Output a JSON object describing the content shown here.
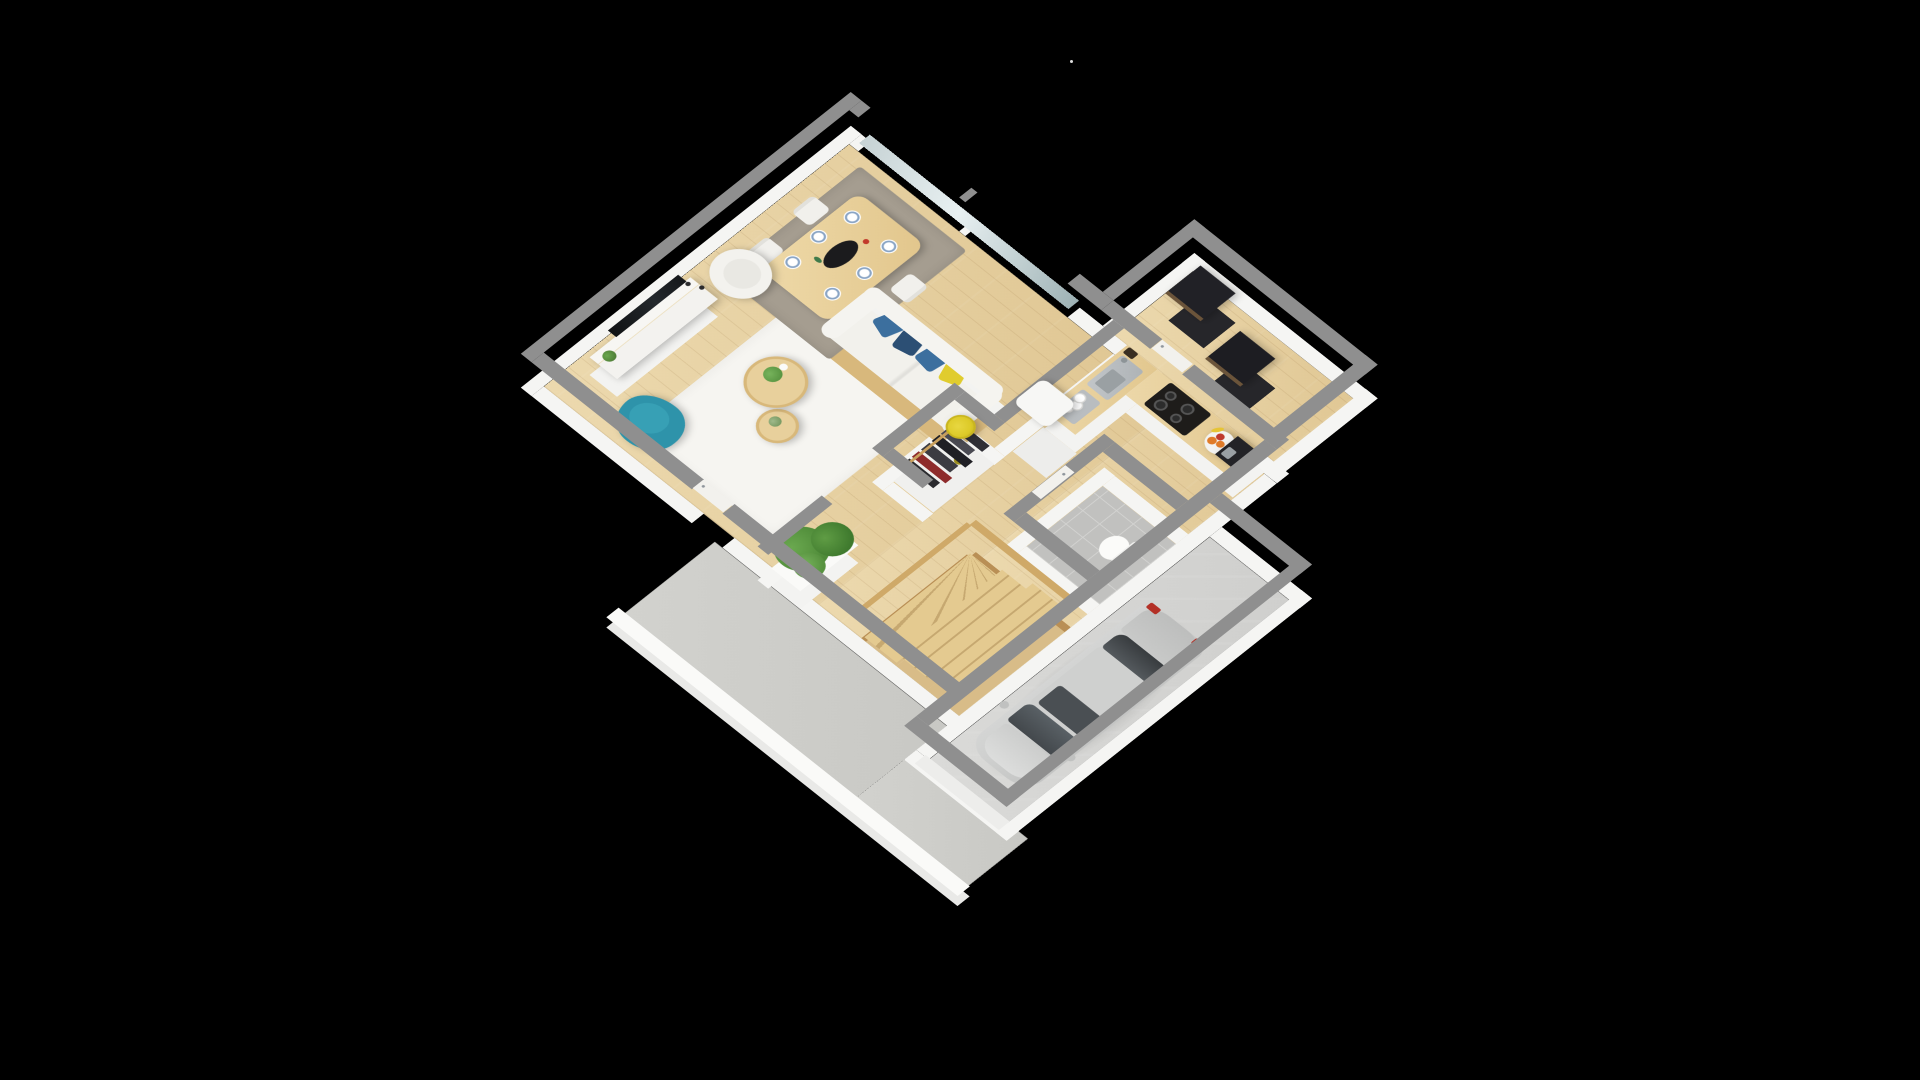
{
  "scene": {
    "label": "3D isometric floor plan of a single-storey house on black background",
    "background_color": "#000000",
    "view": "isometric top-down, plan rotated ~45 degrees",
    "artifact_dot": {
      "x": 1070,
      "y": 60,
      "color": "#dcdcdc"
    }
  },
  "palette": {
    "wall_top": "#8f8f8f",
    "wall_face": "#f5f5f3",
    "wood_floor": "#e7d2a3",
    "garage_floor": "#d5d5d3",
    "tile_floor": "#c1c1bf",
    "concrete": "#cdcdc9",
    "rug_white": "#f6f5f1",
    "rug_taupe": "#a59d90",
    "teal_chair": "#2e93aa",
    "yellow_accent": "#ddca28",
    "sofa_white": "#f2f1ec",
    "pillow_blue": "#3c6f9e",
    "pillow_dark_blue": "#2c4f74",
    "pillow_yellow": "#e0cc2e",
    "plant_green": "#4e8a38",
    "counter_wood": "#e9d3a4",
    "hob_black": "#1e1c1a",
    "car_silver": "#cbcccb",
    "cabinet_black": "#212126",
    "garment_red": "#8e2b2b"
  },
  "rooms": [
    {
      "label": "Living / dining room",
      "floor": "light oak wood"
    },
    {
      "label": "Dining area",
      "floor": "light oak wood"
    },
    {
      "label": "Kitchen",
      "floor": "light oak wood"
    },
    {
      "label": "Wardrobe closet",
      "floor": "white"
    },
    {
      "label": "WC",
      "floor": "grey tiles"
    },
    {
      "label": "Entry hall",
      "floor": "light oak wood"
    },
    {
      "label": "Staircase",
      "floor": "light wood winder stairs"
    },
    {
      "label": "Garage",
      "floor": "grey concrete"
    },
    {
      "label": "Terrace / driveway apron",
      "floor": "concrete"
    }
  ],
  "furniture": {
    "living": {
      "tv_console": {
        "label": "TV sideboard with flat-screen TV, plant and candles"
      },
      "tv": {
        "label": "flat-screen TV",
        "color": "#15171a"
      },
      "teal_armchair": {
        "label": "teal tub armchair",
        "color": "#2e93aa"
      },
      "wingback_chair": {
        "label": "white wingback armchair"
      },
      "sofa": {
        "label": "white sofa with wood frame",
        "pillows": [
          "blue",
          "dark blue",
          "blue",
          "yellow"
        ]
      },
      "nesting_tables": {
        "label": "two round wood nesting coffee tables",
        "count": 2
      },
      "floor_lamp": {
        "label": "yellow floor lamp"
      },
      "rug": {
        "label": "white area rug"
      },
      "plant": {
        "label": "large green plant in white planter"
      }
    },
    "dining": {
      "table": {
        "label": "light wood dining table"
      },
      "chairs": {
        "label": "white dining chairs",
        "count": 4
      },
      "place_settings": {
        "label": "white/blue plates",
        "count": 6
      },
      "centerpiece": {
        "label": "black serving tray with red and green accents"
      },
      "rug": {
        "label": "taupe rug"
      },
      "windows": {
        "label": "glazed window wall with white mullions"
      }
    },
    "kitchen": {
      "fridge": {
        "label": "tall white fridge unit"
      },
      "dish_rack": {
        "label": "dish rack with plates",
        "plates": 4
      },
      "sink": {
        "label": "stainless steel sink with faucet"
      },
      "knife_block": {
        "label": "knife block"
      },
      "hob": {
        "label": "black induction hob",
        "burners": 4
      },
      "fruit_bowl": {
        "label": "fruit plate with bananas and oranges"
      },
      "coffee_maker": {
        "label": "black coffee maker"
      }
    },
    "closet": {
      "label": "open wardrobe with hanging clothes",
      "garments": 6,
      "garment_colors": [
        "#2a2a2e",
        "#8e2b2b",
        "#3c3c42",
        "#1f1f24",
        "#4a4a52",
        "#2f2f35"
      ]
    },
    "wc": {
      "toilet": {
        "label": "white toilet"
      },
      "door": {
        "label": "white door with handle"
      }
    },
    "hall": {
      "black_cabinets": {
        "label": "black cube cabinets",
        "count": 2
      },
      "door": {
        "label": "white interior door"
      }
    },
    "stairs": {
      "label": "light wood winder staircase with balustrade",
      "flights": 3
    },
    "garage": {
      "car": {
        "label": "silver hatchback car parked in garage",
        "color": "silver",
        "details": [
          "dark windshield",
          "panoramic glass roof",
          "red taillights",
          "side mirrors"
        ]
      },
      "door": {
        "label": "garage door opening with grey header"
      }
    },
    "exterior": {
      "garden_wall": {
        "label": "low white garden wall"
      },
      "terrace_door": {
        "label": "white terrace door"
      }
    }
  }
}
